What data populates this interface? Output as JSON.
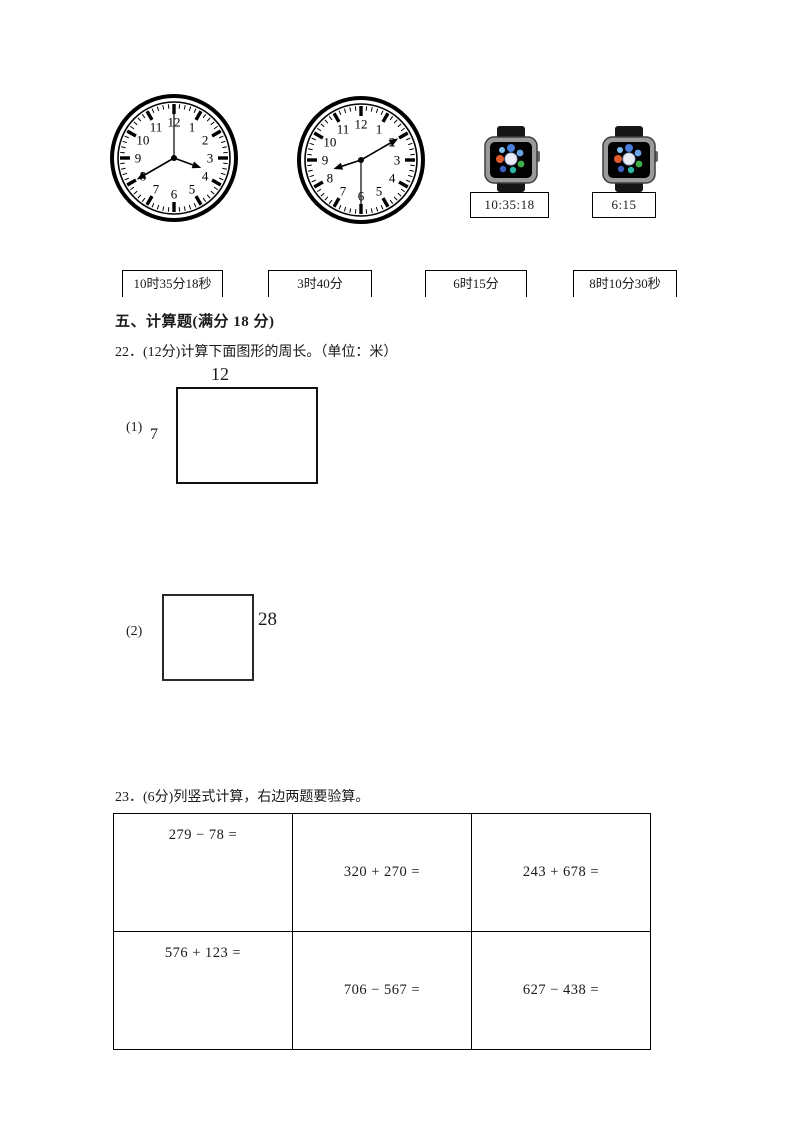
{
  "page": {
    "background": "#ffffff"
  },
  "matching": {
    "clock_numerals": [
      "1",
      "2",
      "3",
      "4",
      "5",
      "6",
      "7",
      "8",
      "9",
      "10",
      "11",
      "12"
    ],
    "clocks": [
      {
        "id": "analog-clock-1",
        "time_shown": "3:40:00",
        "hour_angle": 110,
        "minute_angle": 240,
        "second_angle": 0
      },
      {
        "id": "analog-clock-2",
        "time_shown": "8:10:30",
        "hour_angle": 252,
        "minute_angle": 60,
        "second_angle": 180
      }
    ],
    "watches": [
      {
        "display": "10:35:18"
      },
      {
        "display": "6:15"
      }
    ],
    "answers": [
      "10时35分18秒",
      "3时40分",
      "6时15分",
      "8时10分30秒"
    ]
  },
  "section": {
    "title": "五、计算题(满分 18 分)"
  },
  "q22": {
    "text": "22．(12分)计算下面图形的周长。（单位：米）",
    "figures": [
      {
        "label": "(1)",
        "top_dim": "12",
        "left_dim": "7"
      },
      {
        "label": "(2)",
        "right_dim": "28"
      }
    ]
  },
  "q23": {
    "text": "23．(6分)列竖式计算，右边两题要验算。",
    "problems": [
      [
        "279 − 78 =",
        "320 + 270 =",
        "243 + 678 ="
      ],
      [
        "576 + 123 =",
        "706 − 567 =",
        "627 − 438 ="
      ]
    ]
  },
  "colors": {
    "ink": "#000000",
    "watch_body": "#1c1c1c",
    "watch_bezel": "#8a8a8a"
  }
}
